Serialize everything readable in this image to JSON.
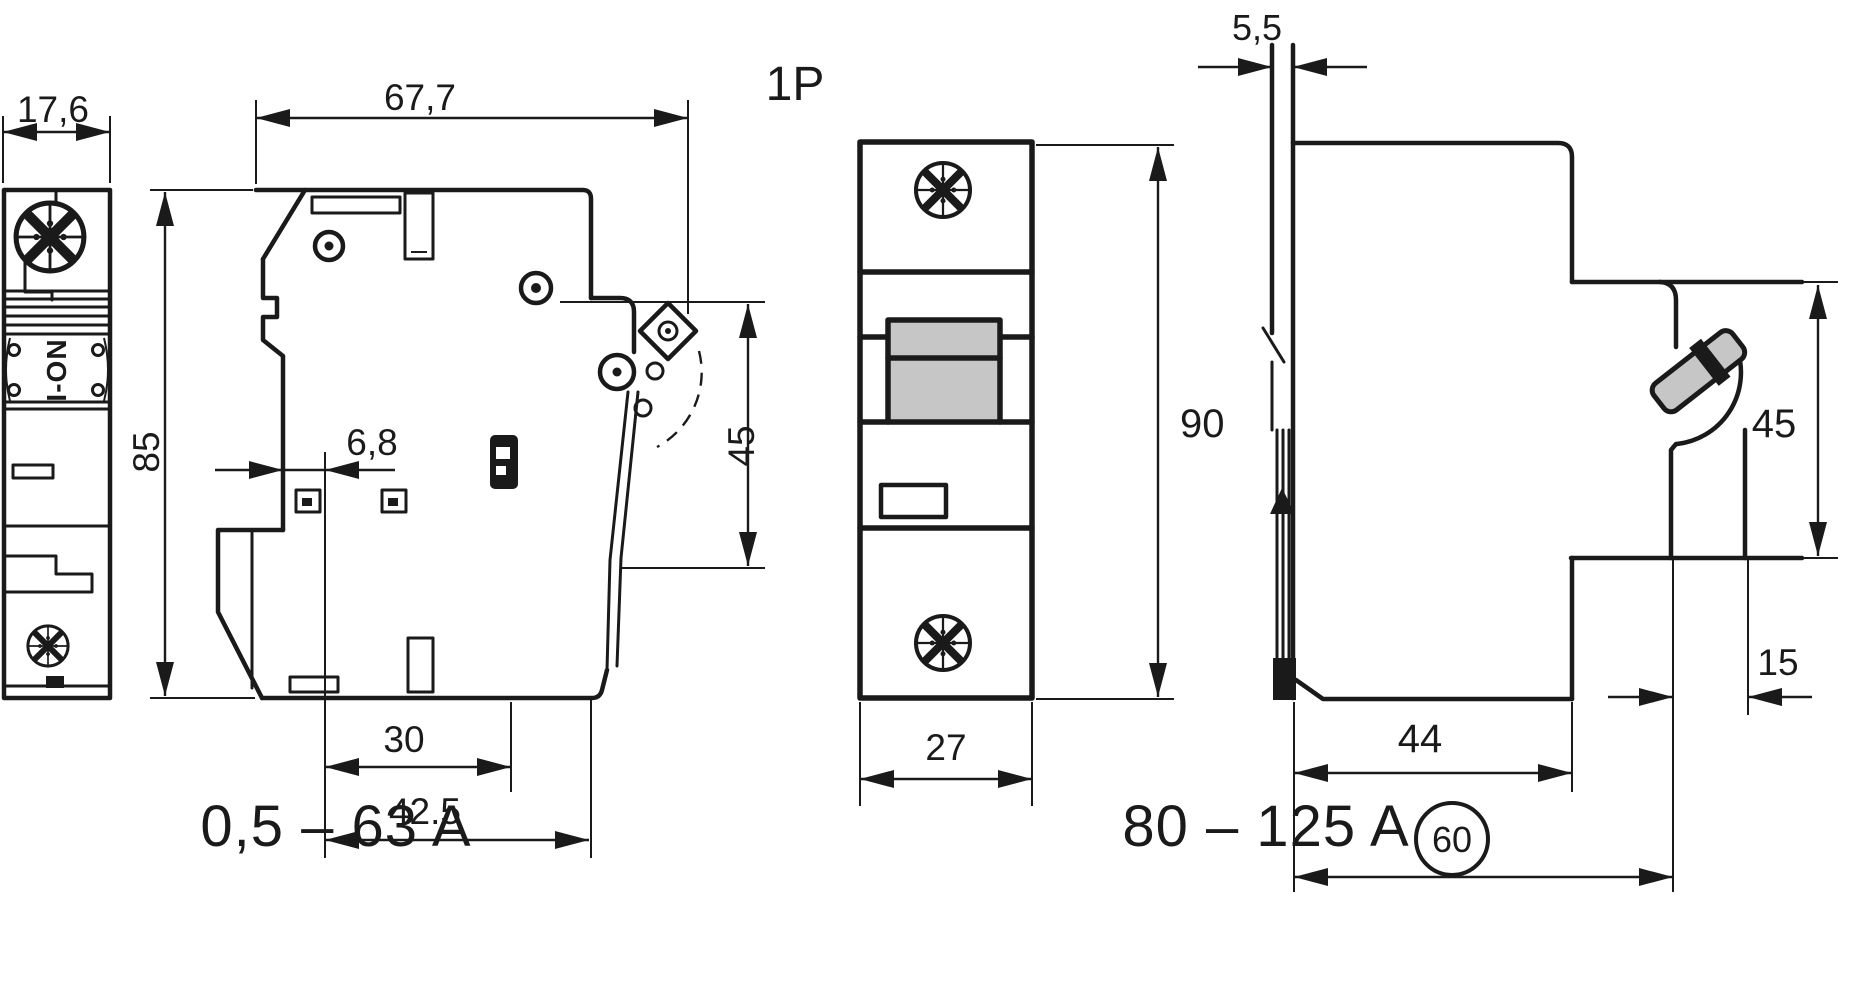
{
  "drawing": {
    "left_view": {
      "width_dim": "17,6",
      "height_dim": "85",
      "handle_label": "I-ON"
    },
    "side_view_small": {
      "depth_dim": "67,7",
      "din_offset_dim": "6,8",
      "handle_zone_dim": "45",
      "slot_distance_dim": "30",
      "edge_distance_dim": "42.5",
      "rating_label": "0,5 – 63 A"
    },
    "front_view_1p": {
      "pole_label": "1P",
      "height_dim": "90",
      "width_dim": "27"
    },
    "side_view_large": {
      "panel_thickness_dim": "5,5",
      "handle_zone_dim": "45",
      "edge_offset_dim": "15",
      "depth_dim": "44",
      "recess_depth_dim": "60",
      "rating_label": "80 – 125 A"
    },
    "colors": {
      "line": "#1a1a1a",
      "handle_fill": "#c6c6c6",
      "background": "#ffffff"
    }
  }
}
